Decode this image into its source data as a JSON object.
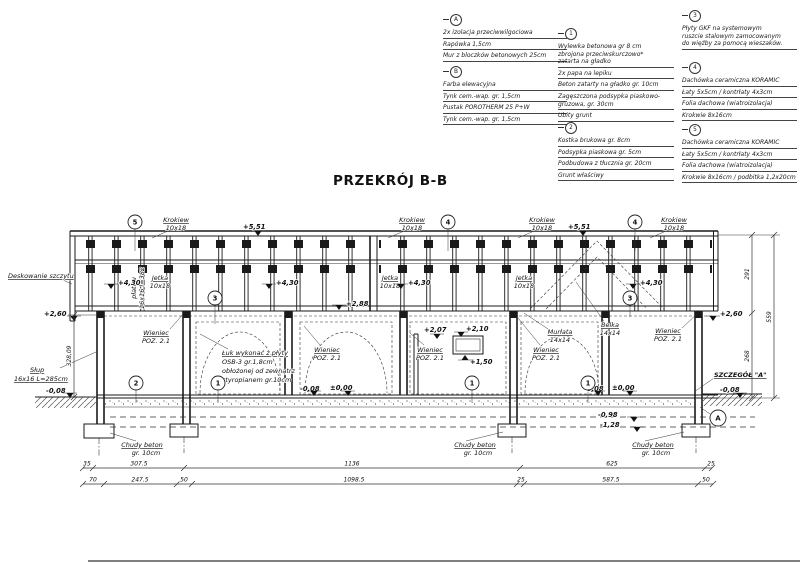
{
  "title": "PRZEKRÓJ B-B",
  "legend": {
    "groups": [
      {
        "id": "A",
        "x": 443,
        "y": 14,
        "w": 124,
        "items": [
          [
            "2x izolacja przeciwwilgociowa"
          ],
          [
            "Rapówka 1,5cm"
          ],
          [
            "Mur z bloczków betonowych 25cm"
          ]
        ]
      },
      {
        "id": "B",
        "x": 443,
        "y": 66,
        "w": 124,
        "items": [
          [
            "Farba elewacyjna"
          ],
          [
            "Tynk cem.-wap. gr. 1,5cm"
          ],
          [
            "Pustak POROTHERM 25 P+W"
          ],
          [
            "Tynk cem.-wap. gr. 1,5cm"
          ]
        ]
      },
      {
        "id": "1",
        "x": 558,
        "y": 28,
        "w": 116,
        "items": [
          [
            "Wylewka betonowa gr 8 cm",
            "zbrojona przeciwskurczowo*",
            "zatarta na gładko"
          ],
          [
            "2x papa na lepiku"
          ],
          [
            "Beton zatarty na gładko gr. 10cm"
          ],
          [
            "Zagęszczona podsypka piaskowo-",
            "gruzowa, gr. 30cm"
          ],
          [
            "Ubity grunt"
          ]
        ]
      },
      {
        "id": "2",
        "x": 558,
        "y": 122,
        "w": 116,
        "items": [
          [
            "Kostka brukowa gr. 8cm"
          ],
          [
            "Podsypka piaskowa gr. 5cm"
          ],
          [
            "Podbudowa z tłucznia gr. 20cm"
          ],
          [
            "Grunt właściwy"
          ]
        ]
      },
      {
        "id": "3",
        "x": 682,
        "y": 10,
        "w": 115,
        "items": [
          [
            "Płyty GKF na systemowym",
            "ruszcie stalowym zamocowanym",
            "do więźby za pomocą wieszaków."
          ]
        ]
      },
      {
        "id": "4",
        "x": 682,
        "y": 62,
        "w": 115,
        "items": [
          [
            "Dachówka ceramiczna KORAMIC"
          ],
          [
            "Łaty 5x5cm / kontrłaty 4x3cm"
          ],
          [
            "Folia dachowa (wiatroizolacja)"
          ],
          [
            "Krokwie 8x16cm"
          ]
        ]
      },
      {
        "id": "5",
        "x": 682,
        "y": 124,
        "w": 115,
        "items": [
          [
            "Dachówka ceramiczna KORAMIC"
          ],
          [
            "Łaty 5x5cm / kontrłaty 4x3cm"
          ],
          [
            "Folia dachowa (wiatroizolacja)"
          ],
          [
            "Krokwie 8x16cm / podbitka 1,2x20cm"
          ]
        ]
      }
    ]
  },
  "drawing": {
    "labels": [
      {
        "t": "Krokiew",
        "x": 176,
        "y": 222,
        "a": "m",
        "c": "u"
      },
      {
        "t": "10x18",
        "x": 176,
        "y": 230,
        "a": "m"
      },
      {
        "t": "Krokiew",
        "x": 412,
        "y": 222,
        "a": "m",
        "c": "u"
      },
      {
        "t": "10x18",
        "x": 412,
        "y": 230,
        "a": "m"
      },
      {
        "t": "Krokiew",
        "x": 542,
        "y": 222,
        "a": "m",
        "c": "u"
      },
      {
        "t": "10x18",
        "x": 542,
        "y": 230,
        "a": "m"
      },
      {
        "t": "Krokiew",
        "x": 674,
        "y": 222,
        "a": "m",
        "c": "u"
      },
      {
        "t": "10x18",
        "x": 674,
        "y": 230,
        "a": "m"
      },
      {
        "t": "Jetka",
        "x": 160,
        "y": 280,
        "a": "m",
        "c": "u"
      },
      {
        "t": "10x18",
        "x": 160,
        "y": 288,
        "a": "m"
      },
      {
        "t": "Jetka",
        "x": 390,
        "y": 280,
        "a": "m",
        "c": "u"
      },
      {
        "t": "10x18",
        "x": 390,
        "y": 288,
        "a": "m"
      },
      {
        "t": "Jetka",
        "x": 524,
        "y": 280,
        "a": "m",
        "c": "u"
      },
      {
        "t": "10x18",
        "x": 524,
        "y": 288,
        "a": "m"
      },
      {
        "t": "płatew",
        "x": 136,
        "y": 288,
        "a": "m",
        "r": -90
      },
      {
        "t": "16x16 l=382",
        "x": 144,
        "y": 288,
        "a": "m",
        "r": -90
      },
      {
        "t": "Deskowanie szczytu",
        "x": 8,
        "y": 278,
        "c": "u"
      },
      {
        "t": "Słup",
        "x": 30,
        "y": 372,
        "c": "u"
      },
      {
        "t": "16x16 L=285cm",
        "x": 14,
        "y": 381,
        "c": "u"
      },
      {
        "t": "Wieniec",
        "x": 156,
        "y": 335,
        "a": "m",
        "c": "u"
      },
      {
        "t": "POZ. 2.1",
        "x": 156,
        "y": 343,
        "a": "m"
      },
      {
        "t": "Wieniec",
        "x": 327,
        "y": 352,
        "a": "m",
        "c": "u"
      },
      {
        "t": "POZ. 2.1",
        "x": 327,
        "y": 360,
        "a": "m"
      },
      {
        "t": "Wieniec",
        "x": 430,
        "y": 352,
        "a": "m",
        "c": "u"
      },
      {
        "t": "POZ. 2.1",
        "x": 430,
        "y": 360,
        "a": "m"
      },
      {
        "t": "Wieniec",
        "x": 546,
        "y": 352,
        "a": "m",
        "c": "u"
      },
      {
        "t": "POZ. 2.1",
        "x": 546,
        "y": 360,
        "a": "m"
      },
      {
        "t": "Wieniec",
        "x": 668,
        "y": 333,
        "a": "m",
        "c": "u"
      },
      {
        "t": "POZ. 2.1",
        "x": 668,
        "y": 341,
        "a": "m"
      },
      {
        "t": "Murłata",
        "x": 560,
        "y": 334,
        "a": "m",
        "c": "u"
      },
      {
        "t": "14x14",
        "x": 560,
        "y": 342,
        "a": "m"
      },
      {
        "t": "Belka",
        "x": 610,
        "y": 327,
        "a": "m",
        "c": "u"
      },
      {
        "t": "14x14",
        "x": 610,
        "y": 335,
        "a": "m"
      },
      {
        "t": "Łuk wykonać z płyty",
        "x": 222,
        "y": 355,
        "c": "u"
      },
      {
        "t": "OSB-3 gr.1,8cm",
        "x": 222,
        "y": 364
      },
      {
        "t": "obłożonej od zewnątrz",
        "x": 222,
        "y": 373
      },
      {
        "t": "styropianem gr.10cm",
        "x": 222,
        "y": 382
      },
      {
        "t": "SZCZEGÓŁ \"A\"",
        "x": 714,
        "y": 377,
        "c": "u b"
      },
      {
        "t": "Chudy beton",
        "x": 142,
        "y": 447,
        "a": "m",
        "c": "u"
      },
      {
        "t": "gr. 10cm",
        "x": 146,
        "y": 455,
        "a": "m"
      },
      {
        "t": "Chudy beton",
        "x": 475,
        "y": 447,
        "a": "m",
        "c": "u"
      },
      {
        "t": "gr. 10cm",
        "x": 478,
        "y": 455,
        "a": "m"
      },
      {
        "t": "Chudy beton",
        "x": 653,
        "y": 447,
        "a": "m",
        "c": "u"
      },
      {
        "t": "gr. 10cm",
        "x": 656,
        "y": 455,
        "a": "m"
      }
    ],
    "levels": [
      {
        "t": "+5,51",
        "x": 243,
        "y": 229,
        "tx": 258,
        "ty": 236,
        "d": 1
      },
      {
        "t": "+5,51",
        "x": 568,
        "y": 229,
        "tx": 583,
        "ty": 236,
        "d": 1
      },
      {
        "t": "+4,30",
        "x": 118,
        "y": 285,
        "tx": 111,
        "ty": 289,
        "d": 1
      },
      {
        "t": "+4,30",
        "x": 276,
        "y": 285,
        "tx": 269,
        "ty": 289,
        "d": 1
      },
      {
        "t": "+4,30",
        "x": 408,
        "y": 285,
        "tx": 401,
        "ty": 289,
        "d": 1
      },
      {
        "t": "+4,30",
        "x": 640,
        "y": 285,
        "tx": 633,
        "ty": 289,
        "d": 1
      },
      {
        "t": "+2,88",
        "x": 346,
        "y": 306,
        "tx": 339,
        "ty": 310,
        "d": 1
      },
      {
        "t": "+2,60",
        "x": 44,
        "y": 316,
        "tx": 74,
        "ty": 321,
        "d": 1
      },
      {
        "t": "+2,60",
        "x": 720,
        "y": 316,
        "tx": 713,
        "ty": 321,
        "d": 1
      },
      {
        "t": "+2,07",
        "x": 424,
        "y": 332,
        "tx": 437,
        "ty": 339,
        "d": 1
      },
      {
        "t": "+2,10",
        "x": 466,
        "y": 331,
        "tx": 461,
        "ty": 337,
        "d": 1
      },
      {
        "t": "+1,50",
        "x": 470,
        "y": 364,
        "tx": 465,
        "ty": 355,
        "d": 0
      },
      {
        "t": "-0,08",
        "x": 300,
        "y": 391,
        "tx": 314,
        "ty": 396,
        "d": 1
      },
      {
        "t": "±0,00",
        "x": 330,
        "y": 390,
        "tx": 348,
        "ty": 396,
        "d": 1
      },
      {
        "t": "-0,08",
        "x": 584,
        "y": 391,
        "tx": 598,
        "ty": 396,
        "d": 1
      },
      {
        "t": "±0,00",
        "x": 612,
        "y": 390,
        "tx": 630,
        "ty": 396,
        "d": 1
      },
      {
        "t": "-0,08",
        "x": 46,
        "y": 393,
        "tx": 70,
        "ty": 398,
        "d": 1
      },
      {
        "t": "-0,08",
        "x": 720,
        "y": 392,
        "tx": 740,
        "ty": 398,
        "d": 1
      },
      {
        "t": "-0,98",
        "x": 598,
        "y": 417,
        "tx": 634,
        "ty": 422,
        "d": 1
      },
      {
        "t": "-1,28",
        "x": 600,
        "y": 427,
        "tx": 637,
        "ty": 432,
        "d": 1
      }
    ],
    "markers": [
      {
        "t": "5",
        "x": 135,
        "y": 222
      },
      {
        "t": "4",
        "x": 448,
        "y": 222
      },
      {
        "t": "4",
        "x": 635,
        "y": 222
      },
      {
        "t": "3",
        "x": 215,
        "y": 298
      },
      {
        "t": "3",
        "x": 630,
        "y": 298
      },
      {
        "t": "2",
        "x": 136,
        "y": 383
      },
      {
        "t": "1",
        "x": 218,
        "y": 383
      },
      {
        "t": "1",
        "x": 472,
        "y": 383
      },
      {
        "t": "1",
        "x": 588,
        "y": 383
      },
      {
        "t": "A",
        "x": 718,
        "y": 418,
        "r": 8
      }
    ],
    "dims": [
      {
        "o": "h",
        "y": 468,
        "x1": 83,
        "x2": 712,
        "ticks": [
          83,
          93,
          184,
          520,
          705,
          712
        ],
        "labels": [
          {
            "t": "35",
            "x": 87
          },
          {
            "t": "307.5",
            "x": 139
          },
          {
            "t": "1136",
            "x": 352
          },
          {
            "t": "625",
            "x": 612
          },
          {
            "t": "25",
            "x": 711
          }
        ]
      },
      {
        "o": "h",
        "y": 484,
        "x1": 83,
        "x2": 713,
        "ticks": [
          83,
          104,
          177,
          192,
          517,
          524,
          698,
          713
        ],
        "labels": [
          {
            "t": "70",
            "x": 93
          },
          {
            "t": "247.5",
            "x": 140
          },
          {
            "t": "50",
            "x": 184
          },
          {
            "t": "1098.5",
            "x": 354
          },
          {
            "t": "25",
            "x": 521
          },
          {
            "t": "587.5",
            "x": 611
          },
          {
            "t": "50",
            "x": 706
          }
        ]
      },
      {
        "o": "v",
        "x": 752,
        "y1": 235,
        "y2": 398,
        "ticks": [
          235,
          313,
          398
        ],
        "labels": [
          {
            "t": "291",
            "y": 274
          },
          {
            "t": "268",
            "y": 356
          }
        ]
      },
      {
        "o": "v",
        "x": 774,
        "y1": 235,
        "y2": 398,
        "ticks": [
          235,
          398
        ],
        "labels": [
          {
            "t": "559",
            "y": 317
          }
        ]
      },
      {
        "o": "v",
        "x": 74,
        "y1": 315,
        "y2": 397,
        "ticks": [
          315,
          397
        ],
        "labels": [
          {
            "t": "328,09",
            "y": 356
          }
        ]
      }
    ]
  }
}
